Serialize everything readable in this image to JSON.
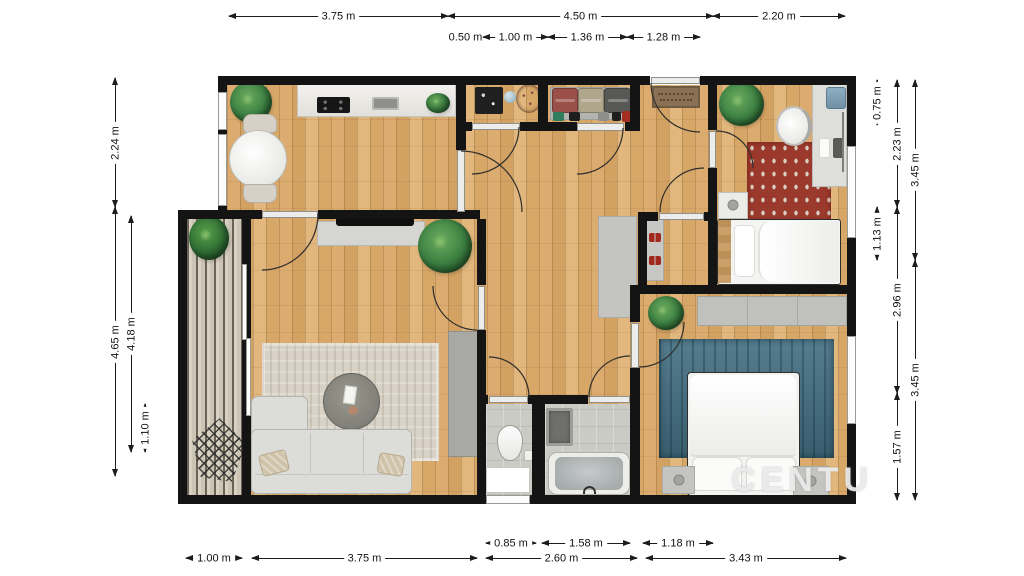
{
  "watermark": "CENTU",
  "colors": {
    "wall": "#141414",
    "wood_floor": "#d9a96c",
    "balcony_deck": "#d9d1c2",
    "tile_floor": "#cbcbc5",
    "living_rug": "#d8d2c6",
    "red_rug": "#9c392d",
    "blue_rug": "#426e80",
    "counter": "#eceae6",
    "gray_furniture": "#c4c4c1",
    "sofa": "#dcdcd9",
    "plant_green": "#3f8344",
    "doormat": "#8a7156",
    "red_shoes": "#a2271d",
    "dimension_line": "#1c1c1c"
  },
  "dimensions": [
    {
      "o": "h",
      "label": "3.75 m",
      "x1": 229,
      "x2": 448,
      "y": 16
    },
    {
      "o": "h",
      "label": "4.50 m",
      "x1": 448,
      "x2": 713,
      "y": 16
    },
    {
      "o": "h",
      "label": "2.20 m",
      "x1": 713,
      "x2": 845,
      "y": 16
    },
    {
      "o": "h",
      "label": "0.50 m",
      "x1": 448,
      "x2": 483,
      "y": 37
    },
    {
      "o": "h",
      "label": "1.00 m",
      "x1": 483,
      "x2": 548,
      "y": 37
    },
    {
      "o": "h",
      "label": "1.36 m",
      "x1": 548,
      "x2": 627,
      "y": 37
    },
    {
      "o": "h",
      "label": "1.28 m",
      "x1": 627,
      "x2": 700,
      "y": 37
    },
    {
      "o": "v",
      "label": "2.24 m",
      "x": 115,
      "y1": 78,
      "y2": 207
    },
    {
      "o": "v",
      "label": "4.65 m",
      "x": 115,
      "y1": 207,
      "y2": 476
    },
    {
      "o": "v",
      "label": "4.18 m",
      "x": 131,
      "y1": 216,
      "y2": 452
    },
    {
      "o": "v",
      "label": "1.10 m",
      "x": 145,
      "y1": 404,
      "y2": 452
    },
    {
      "o": "v",
      "label": "0.75 m",
      "x": 877,
      "y1": 80,
      "y2": 125
    },
    {
      "o": "v",
      "label": "2.23 m",
      "x": 897,
      "y1": 80,
      "y2": 207
    },
    {
      "o": "v",
      "label": "3.45 m",
      "x": 915,
      "y1": 80,
      "y2": 260
    },
    {
      "o": "v",
      "label": "1.13 m",
      "x": 877,
      "y1": 207,
      "y2": 260
    },
    {
      "o": "v",
      "label": "2.96 m",
      "x": 897,
      "y1": 207,
      "y2": 393
    },
    {
      "o": "v",
      "label": "3.45 m",
      "x": 915,
      "y1": 260,
      "y2": 500
    },
    {
      "o": "v",
      "label": "1.57 m",
      "x": 897,
      "y1": 393,
      "y2": 500
    },
    {
      "o": "h",
      "label": "0.85 m",
      "x1": 486,
      "x2": 536,
      "y": 543
    },
    {
      "o": "h",
      "label": "1.58 m",
      "x1": 542,
      "x2": 630,
      "y": 543
    },
    {
      "o": "h",
      "label": "1.18 m",
      "x1": 643,
      "x2": 713,
      "y": 543
    },
    {
      "o": "h",
      "label": "1.00 m",
      "x1": 186,
      "x2": 242,
      "y": 558
    },
    {
      "o": "h",
      "label": "3.75 m",
      "x1": 252,
      "x2": 477,
      "y": 558
    },
    {
      "o": "h",
      "label": "2.60 m",
      "x1": 486,
      "x2": 637,
      "y": 558
    },
    {
      "o": "h",
      "label": "3.43 m",
      "x1": 646,
      "x2": 846,
      "y": 558
    }
  ]
}
